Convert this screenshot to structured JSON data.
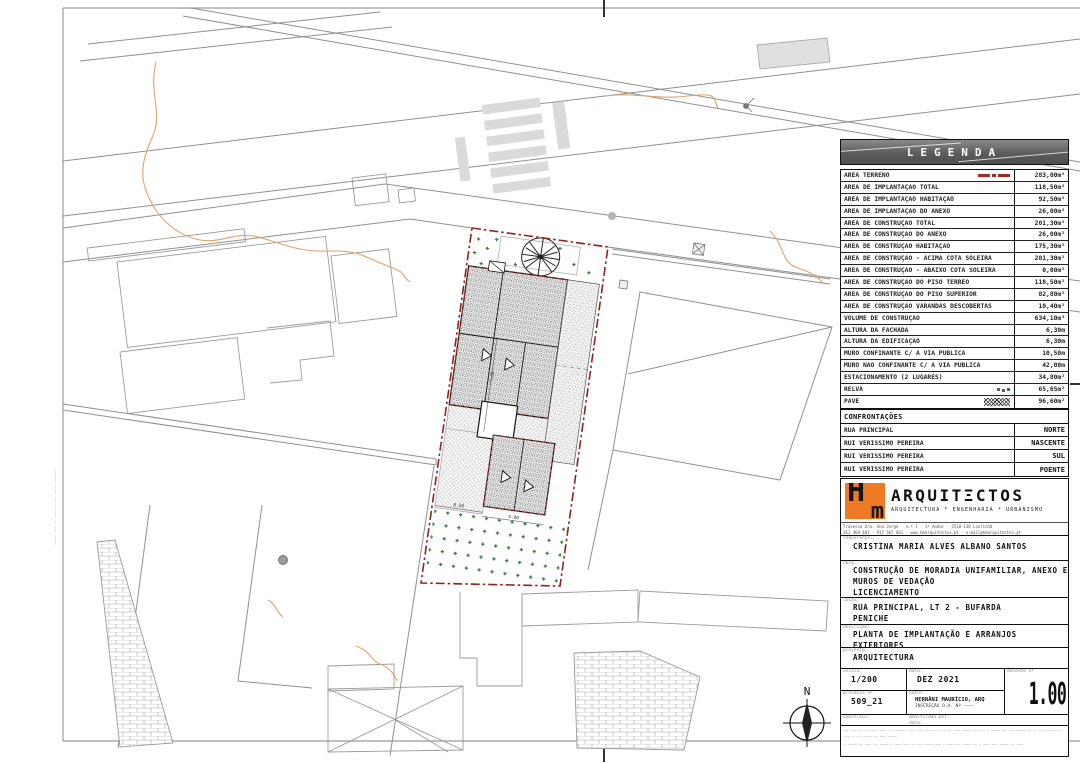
{
  "legend": {
    "title": "LEGENDA",
    "rows": [
      {
        "label": "ÁREA TERRENO",
        "value": "283,00m²"
      },
      {
        "label": "ÁREA DE IMPLANTAÇÃO TOTAL",
        "value": "118,50m²"
      },
      {
        "label": "ÁREA DE IMPLANTAÇÃO HABITAÇÃO",
        "value": "92,50m²"
      },
      {
        "label": "ÁREA DE IMPLANTAÇÃO DO ANEXO",
        "value": "26,00m²"
      },
      {
        "label": "ÁREA DE CONSTRUÇÃO TOTAL",
        "value": "201,30m²"
      },
      {
        "label": "ÁREA DE CONSTRUÇÃO DO ANEXO",
        "value": "26,00m²"
      },
      {
        "label": "ÁREA DE CONSTRUÇÃO HABITAÇÃO",
        "value": "175,30m²"
      },
      {
        "label": "ÁREA DE CONSTRUÇÃO - ACIMA COTA SOLEIRA",
        "value": "201,30m²"
      },
      {
        "label": "ÁREA DE CONSTRUÇÃO - ABAIXO COTA SOLEIRA",
        "value": "0,00m²"
      },
      {
        "label": "ÁREA DE CONSTRUÇÃO DO PISO TÉRREO",
        "value": "118,50m²"
      },
      {
        "label": "ÁREA DE CONSTRUÇÃO DO PISO SUPERIOR",
        "value": "82,80m²"
      },
      {
        "label": "ÁREA DE CONSTRUÇÃO VARANDAS DESCOBERTAS",
        "value": "10,40m²"
      },
      {
        "label": "VOLUME DE CONSTRUÇÃO",
        "value": "634,10m³"
      },
      {
        "label": "ALTURA DA FACHADA",
        "value": "6,30m"
      },
      {
        "label": "ALTURA DA EDIFICAÇÃO",
        "value": "6,30m"
      },
      {
        "label": "MURO CONFINANTE C/ A VIA PÚBLICA",
        "value": "10,50m"
      },
      {
        "label": "MURO NÃO CONFINANTE C/ A VIA PÚBLICA",
        "value": "42,00m"
      },
      {
        "label": "ESTACIONAMENTO (2 LUGARES)",
        "value": "34,80m²"
      },
      {
        "label": "RELVA",
        "value": "65,65m²"
      },
      {
        "label": "PAVÊ",
        "value": "96,60m²"
      }
    ],
    "confront_title": "CONFRONTAÇÕES",
    "confront": [
      {
        "label": "RUA PRINCIPAL",
        "value": "NORTE"
      },
      {
        "label": "RUI VERISSIMO PEREIRA",
        "value": "NASCENTE"
      },
      {
        "label": "RUI VERISSIMO PEREIRA",
        "value": "SUL"
      },
      {
        "label": "RUI VERISSIMO PEREIRA",
        "value": "POENTE"
      }
    ]
  },
  "firm": {
    "logo_h": "H",
    "logo_m": "m",
    "name": "ARQUITΞCTOS",
    "tagline": "ARQUITECTURA * ENGENHARIA * URBANISMO",
    "address_line1": "Travessa Dra. Ana Jorge · n.º 1 · 1º Andar · 2510-138 Lourinhã",
    "address_line2": "261 469 481 · 917 567 661 · www.hmarquitectos.pt · e-mail@hmarquitectos.pt"
  },
  "titleblock": {
    "requerente_label": "requerente:",
    "requerente": "CRISTINA MARIA ALVES ALBANO SANTOS",
    "obra_label": "obra:",
    "obra_line1": "CONSTRUÇÃO DE MORADIA UNIFAMILIAR, ANEXO E",
    "obra_line2": "MUROS DE VEDAÇÃO",
    "obra_line3": "LICENCIAMENTO",
    "local_label": "local:",
    "local_line1": "RUA PRINCIPAL, LT 2 - BUFARDA",
    "local_line2": "PENICHE",
    "descricao_label": "descrição:",
    "descricao": "PLANTA DE IMPLANTAÇÃO E ARRANJOS EXTERIORES",
    "projecto_label": "projecto:",
    "projecto": "ARQUITECTURA",
    "escala_label": "escala:",
    "escala": "1/200",
    "data_label": "data:",
    "data": "DEZ 2021",
    "desenho_label": "desenho nº",
    "desenho": "1.00",
    "processo_label": "processo nº",
    "processo": "509_21",
    "autor_label": "autor:",
    "autor_line1": "HERNÂNI MAURÍCIO, ARQ",
    "autor_line2": "INSCRIÇÃO O.A. Nº ––––",
    "substitui_label": "substitui:",
    "modificado_label": "modificado por:",
    "modificado_data_label": "data:",
    "disclaimer1": "–– ––– –– – –––– ––– –– –––– – ––– –– –––– ––– – –– ––– –––– –– ––– – –––– –– ––– –––– –– – ––– –––– –– ––– – –– –––– –– ––– ––––",
    "disclaimer2": "– –––– –– ––– –– –––– – ––– ––– –– –– –––– ––– – ––– –– –––– –– – ––– ––– –––– –– –––"
  },
  "plan": {
    "north": "N",
    "dim1": "8.50",
    "dim2": "4.00",
    "dim3": "7.00",
    "margin_note": "––––– ––– –– –––––– ––– ––––– ––––––"
  }
}
